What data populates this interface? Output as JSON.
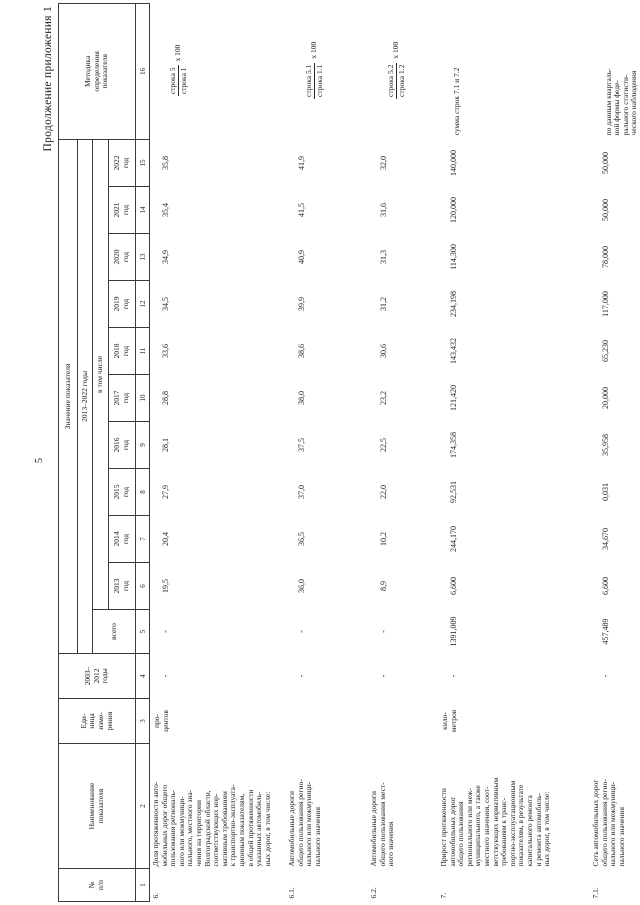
{
  "page": {
    "continuation": "Продолжение приложения 1",
    "number": "5"
  },
  "colors": {
    "text": "#1c1c1c",
    "border": "#3a3a3a",
    "background": "#ffffff"
  },
  "table": {
    "header": {
      "no": "№\nп/п",
      "name": "Наименование\nпоказателя",
      "unit": "Еди-\nница\nизме-\nрения",
      "period_2003_2012": "2003–\n2012\nгоды",
      "value_group": "Значение показателя",
      "period_2013_2022": "2013–2022 годы",
      "total": "всего",
      "including": "в том числе",
      "years": [
        "2013\nгод",
        "2014\nгод",
        "2015\nгод",
        "2016\nгод",
        "2017\nгод",
        "2018\nгод",
        "2019\nгод",
        "2020\nгод",
        "2021\nгод",
        "2022\nгод"
      ],
      "methodology": "Методика\nопределения\nпоказателя",
      "column_numbers": [
        "1",
        "2",
        "3",
        "4",
        "5",
        "6",
        "7",
        "8",
        "9",
        "10",
        "11",
        "12",
        "13",
        "14",
        "15",
        "16"
      ]
    },
    "rows": [
      {
        "num": "6.",
        "name": "Доля протяженности авто-\nмобильных дорог общего\nпользования региональ-\nного или межмуници-\nпального, местного зна-\nчения на территории\nВолгоградской области,\nсоответствующих нор-\nмативным требованиям\nк транспортно-эксплуата-\nционным показателям,\nв общей протяженности\nуказанных автомобиль-\nных дорог, в том числе:",
        "unit": "про-\nцентов",
        "values": [
          "-",
          "-",
          "19,5",
          "20,4",
          "27,9",
          "28,1",
          "28,8",
          "33,6",
          "34,5",
          "34,9",
          "35,4",
          "35,8"
        ],
        "method": {
          "num": "строка 5",
          "den": "строка 1",
          "suffix": "х 100"
        }
      },
      {
        "num": "6.1.",
        "name": "Автомобильные дороги\nобщего пользования регио-\nнального или межмуници-\nпального значения",
        "unit": "",
        "values": [
          "-",
          "-",
          "36,0",
          "36,5",
          "37,0",
          "37,5",
          "38,0",
          "38,6",
          "39,9",
          "40,9",
          "41,5",
          "41,9"
        ],
        "method": {
          "num": "строка 5.1",
          "den": "строка 1.1",
          "suffix": "х 100"
        }
      },
      {
        "num": "6.2.",
        "name": "Автомобильные дороги\nобщего пользования мест-\nного значения",
        "unit": "",
        "values": [
          "-",
          "-",
          "8,9",
          "10,2",
          "22,0",
          "22,5",
          "23,2",
          "30,6",
          "31,2",
          "31,3",
          "31,6",
          "32,0"
        ],
        "method": {
          "num": "строка 5.2",
          "den": "строка 1.2",
          "suffix": "х 100"
        }
      },
      {
        "num": "7.",
        "name": "Прирост протяженности\nавтомобильных дорог\nобщего пользования\nрегионального или меж-\nмуниципального, а также\nместного значения, соот-\nветствующих нормативным\nтребованиям к транс-\nпортно-эксплуатационным\nпоказателям, в результате\nкапитального ремонта\nи ремонта автомобиль-\nных дорог, в том числе:",
        "unit": "кило-\nметров",
        "values": [
          "-",
          "1391,009",
          "6,600",
          "244,170",
          "92,531",
          "174,358",
          "121,420",
          "143,432",
          "234,198",
          "114,300",
          "120,000",
          "140,000"
        ],
        "method": {
          "text": "сумма строк 7.1 и 7.2"
        }
      },
      {
        "num": "7.1.",
        "name": "Сеть автомобильных дорог\nобщего пользования регио-\nнального или межмуници-\nпального значения",
        "unit": "",
        "values": [
          "-",
          "457,489",
          "6,600",
          "34,670",
          "0,031",
          "35,958",
          "20,000",
          "65,230",
          "117,000",
          "78,000",
          "50,000",
          "50,000"
        ],
        "method": {
          "text": "по данным кварталь-\nной формы феде-\nрального статисти-\nческого наблюдения\n№ 3-автодор"
        }
      }
    ]
  }
}
